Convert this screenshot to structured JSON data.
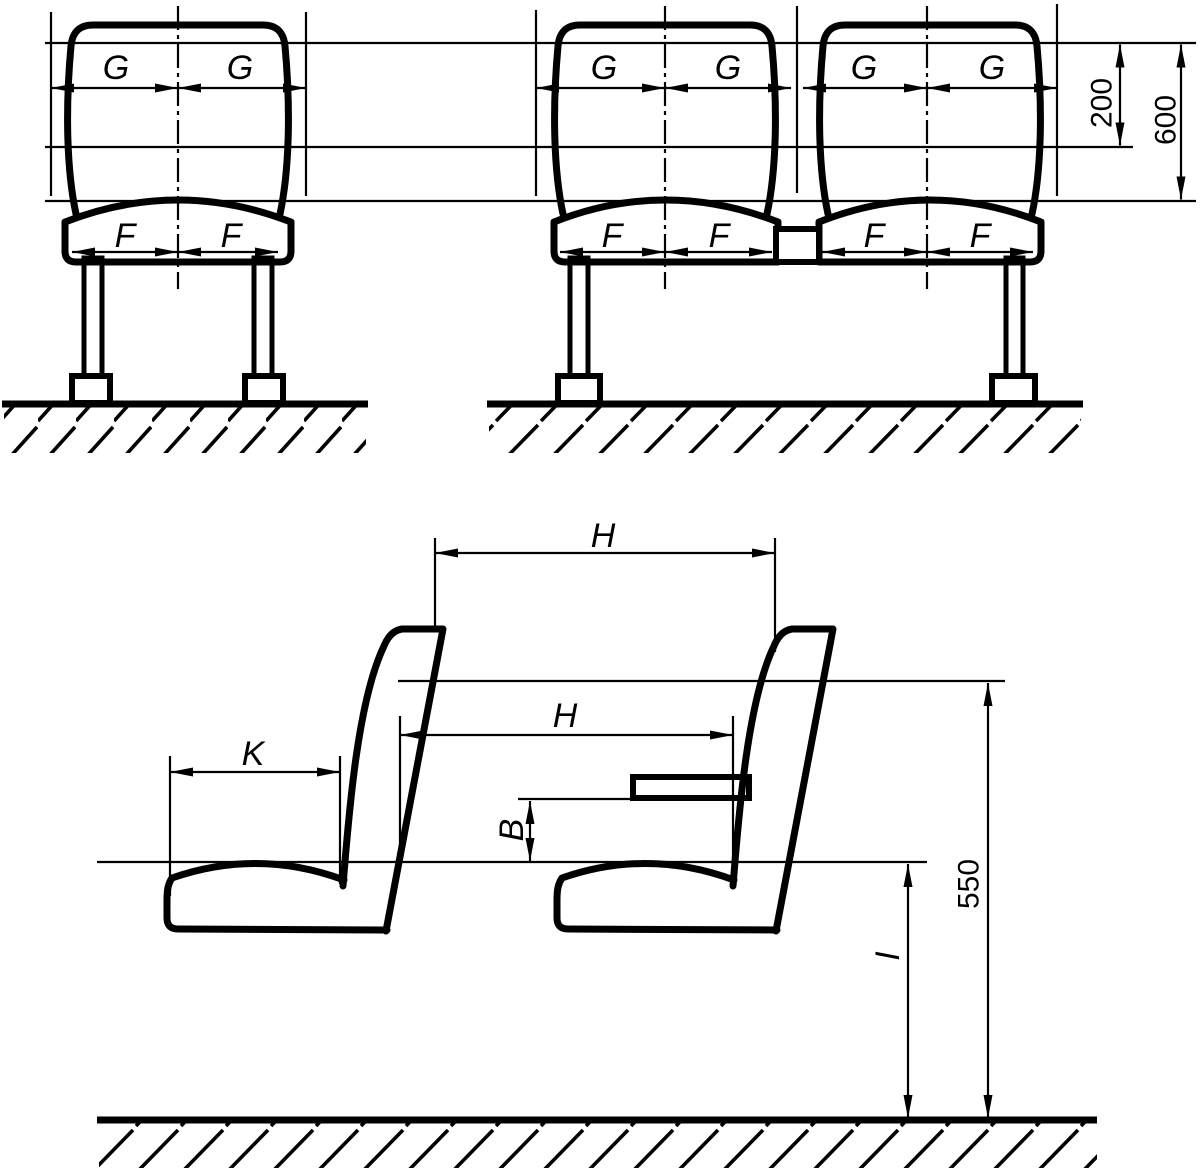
{
  "figure": {
    "front_view": {
      "g_label": "G",
      "f_label": "F",
      "dim_200": "200",
      "dim_600": "600"
    },
    "side_view": {
      "h_label": "H",
      "k_label": "K",
      "b_label": "B",
      "i_label": "I",
      "dim_550": "550"
    }
  }
}
